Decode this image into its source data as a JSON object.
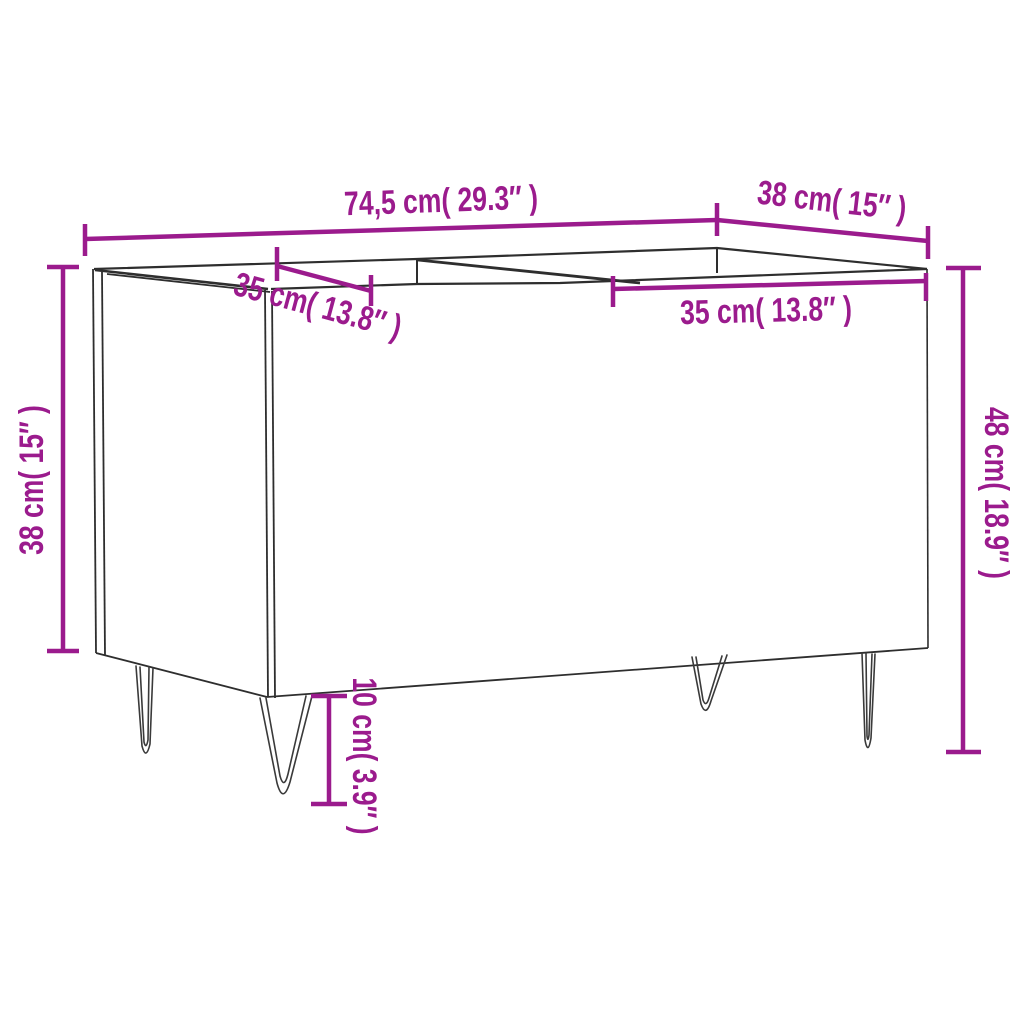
{
  "diagram": {
    "labels": {
      "overall_width": "74,5 cm( 29.3″ )",
      "depth": "38 cm( 15″ )",
      "body_height": "38 cm( 15″ )",
      "total_height": "48 cm( 18.9″ )",
      "left_compartment_width": "35 cm( 13.8″ )",
      "right_compartment_width": "35 cm( 13.8″ )",
      "leg_height": "10 cm( 3.9″ )"
    },
    "colors": {
      "dimension": "#9B1B8D",
      "outline": "#2E2E2E",
      "background": "#FFFFFF"
    }
  }
}
